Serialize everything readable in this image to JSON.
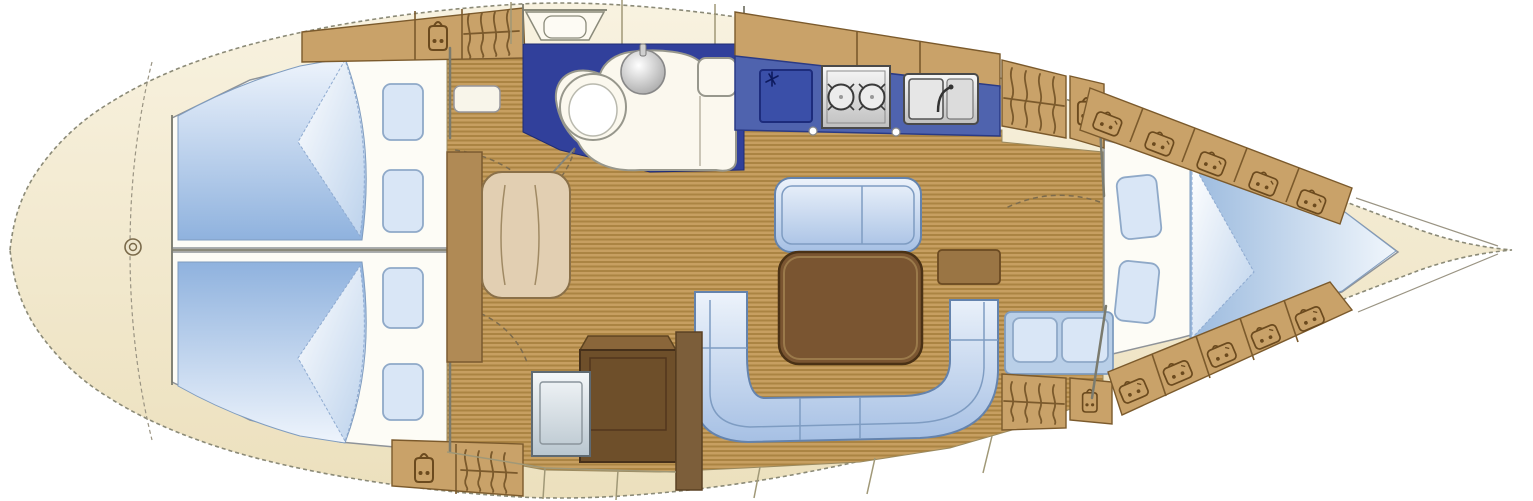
{
  "meta": {
    "type": "sailing-yacht-interior-floor-plan",
    "orientation": "bow-right, stern-left, top-down view"
  },
  "colors": {
    "bg": "#ffffff",
    "hullFillTop": "#f8f2e0",
    "hullFillBottom": "#ece0bd",
    "hullEdge": "#8b8a77",
    "room": "#fdfcf6",
    "wall": "#7b7b6e",
    "door": "#7d6c4e",
    "woodLight": "#c79f61",
    "woodDark": "#ab8443",
    "lockerFill": "#c9a269",
    "lockerEdge": "#7b5a2c",
    "navy": "#31409b",
    "counter": "#4f63ae",
    "fridge": "#3a4fa8",
    "fixture": "#fbf8ee",
    "blanketLight": "#eef4fc",
    "blanketDeep": "#8fb2de",
    "settee": "#a6c0e4",
    "setteeEdge": "#6483ad",
    "pillow": "#d9e6f6",
    "tableTop": "#7a5531",
    "tableEdge": "#4a3115",
    "chartTable": "#6e4f2a",
    "seatTan": "#e2cfb2"
  },
  "regions": [
    {
      "id": "stern-deck",
      "label": "stern deck with rudder post"
    },
    {
      "id": "aft-cabin-upper",
      "label": "aft double cabin (upper)",
      "furniture": [
        "double-berth with turned-down blanket",
        "two pillows",
        "shelf locker",
        "hanging locker"
      ]
    },
    {
      "id": "aft-cabin-lower",
      "label": "aft double cabin (lower)",
      "furniture": [
        "double-berth with turned-down blanket",
        "two pillows",
        "shelf locker",
        "hanging locker"
      ]
    },
    {
      "id": "head",
      "label": "head / bathroom",
      "furniture": [
        "toilet",
        "round washbasin",
        "vanity counter",
        "cistern seat"
      ]
    },
    {
      "id": "companionway",
      "label": "companionway entry steps"
    },
    {
      "id": "galley",
      "label": "galley",
      "furniture": [
        "top-loading refrigerator",
        "two-burner stove",
        "sink with drainboard"
      ]
    },
    {
      "id": "salon",
      "label": "salon",
      "furniture": [
        "straight settee",
        "dining table",
        "u-shaped settee",
        "sideboard console"
      ]
    },
    {
      "id": "nav-station",
      "label": "navigation station",
      "furniture": [
        "navigator seat",
        "chart table",
        "instrument panel"
      ]
    },
    {
      "id": "forward-cabin",
      "label": "forward V-berth cabin",
      "furniture": [
        "v-berth with turned-down blanket",
        "two pillows",
        "two-seat bench",
        "hanging locker",
        "shelf lockers along hull"
      ]
    },
    {
      "id": "bow-locker",
      "label": "bow / anchor locker"
    }
  ],
  "icons": [
    {
      "name": "shelf-locker-icon",
      "meaning": "storage locker with contents"
    },
    {
      "name": "hanging-locker-icon",
      "meaning": "wardrobe with hanging clothes"
    },
    {
      "name": "snowflake-icon",
      "meaning": "refrigerator"
    },
    {
      "name": "burner-icon",
      "meaning": "stove burner"
    },
    {
      "name": "rudder-post-icon",
      "meaning": "rudder stock"
    }
  ]
}
